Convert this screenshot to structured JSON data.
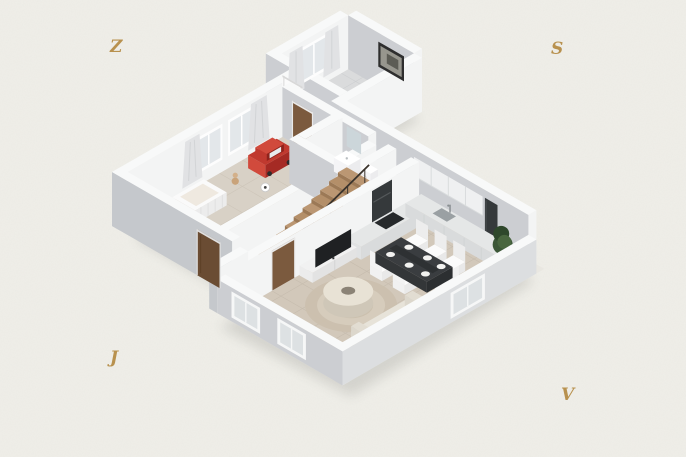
{
  "page": {
    "type": "isometric-floor-plan-render"
  },
  "compass": {
    "west": {
      "label": "Z"
    },
    "north": {
      "label": "S"
    },
    "south": {
      "label": "J"
    },
    "east": {
      "label": "V"
    },
    "color": "#b8914e"
  },
  "colors": {
    "background": "#efeee8",
    "shadow": "#2a2a26",
    "slab": "#e9e7e1",
    "wall_top": "#f8f9f9",
    "wall_se": "#f3f4f4",
    "wall_sw": "#ccced2",
    "wall_sw_dark": "#c5c8cc",
    "wall_int": "#eff0f1",
    "floor_wood": "#d2c8ba",
    "floor_wood_line": "#c6bcae",
    "floor_child": "#d8d1c6",
    "floor_child_line": "#cdc5b9",
    "floor_tile": "#dadbdc",
    "floor_tile_line": "#cdcfd1",
    "stairs_wood": "#b48f69",
    "stairs_wood_alt": "#bb9773",
    "stairs_riser": "#9c7956",
    "rail_dark": "#3a332c",
    "door_wood": "#7b5a3e",
    "door_wood_dark": "#6a4c33",
    "door_frame": "#e9e9e9",
    "white_door": "#fbfbfb",
    "glass": "#e3e7ea",
    "window_frame": "#fdfdfd",
    "curtain": "#e1e2e4",
    "curtain_fold": "#d2d4d6",
    "toy_car_red": "#c0392f",
    "toy_car_red_dark": "#a52a24",
    "toy_car_red_light": "#d14a3c",
    "crib_white": "#fafafa",
    "rug": "#cbc0ae",
    "rug_ring": "#d6ccbc",
    "coffee_table": "#e8e2d5",
    "coffee_table_side": "#cfc7b8",
    "table_dark": "#3a3d40",
    "table_dark_side": "#2c2f31",
    "chair_white": "#fbfbfb",
    "chair_shade": "#e9e9e9",
    "tv_dark": "#1f2123",
    "cabinet_white": "#f2f3f3",
    "counter_top": "#e5e7e7",
    "counter_face": "#d9dbdc",
    "dark_unit": "#35393b",
    "sink_gray": "#9aa0a3",
    "mirror": "#ccd6da",
    "sofa": "#e7e3d9",
    "sofa_back": "#ded9cd",
    "plant_green_1": "#3c5737",
    "plant_green_2": "#2e472b",
    "plant_green_3": "#49663f",
    "picture_frame": "#2e2e2e",
    "picture_inner": "#97968e",
    "picture_art": "#5c5c55"
  },
  "scene": {
    "rooms": [
      {
        "name": "children-room"
      },
      {
        "name": "entry-hall"
      },
      {
        "name": "corridor"
      },
      {
        "name": "bathroom"
      },
      {
        "name": "kitchen"
      },
      {
        "name": "dining-area"
      },
      {
        "name": "living-area"
      },
      {
        "name": "staircase"
      }
    ],
    "furniture": [
      {
        "name": "crib"
      },
      {
        "name": "toy-car"
      },
      {
        "name": "soccer-ball"
      },
      {
        "name": "teddy-bear"
      },
      {
        "name": "staircase-steps"
      },
      {
        "name": "stair-railing"
      },
      {
        "name": "washbasin"
      },
      {
        "name": "mirror"
      },
      {
        "name": "toilet"
      },
      {
        "name": "kitchen-counter"
      },
      {
        "name": "kitchen-sink"
      },
      {
        "name": "upper-cabinets"
      },
      {
        "name": "tall-dark-cabinet"
      },
      {
        "name": "dining-table"
      },
      {
        "name": "dining-chairs"
      },
      {
        "name": "tv-cabinet"
      },
      {
        "name": "tv"
      },
      {
        "name": "round-rug"
      },
      {
        "name": "coffee-table"
      },
      {
        "name": "sofa"
      },
      {
        "name": "plant"
      },
      {
        "name": "picture-frame"
      },
      {
        "name": "window-with-curtains"
      },
      {
        "name": "entry-door"
      },
      {
        "name": "interior-door"
      }
    ]
  }
}
